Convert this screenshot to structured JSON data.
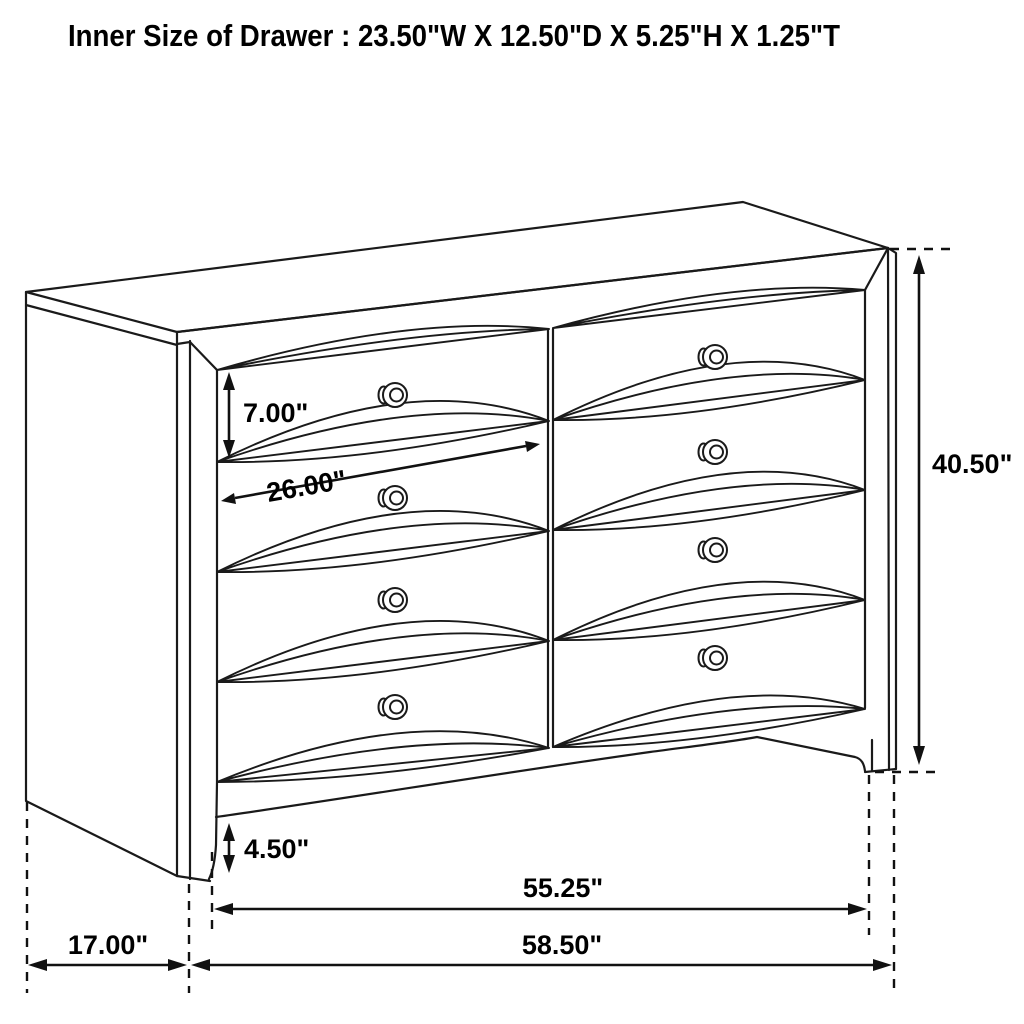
{
  "page": {
    "title": "Inner Size of Drawer : 23.50\"W X 12.50\"D X 5.25\"H X 1.25\"T",
    "background_color": "#ffffff",
    "line_color": "#1a1a1a"
  },
  "diagram": {
    "subject": "eight-drawer dresser line drawing",
    "view": "front three-quarter perspective",
    "drawer_grid": {
      "columns": 2,
      "rows": 4,
      "knobs": 8
    },
    "dimensions": [
      {
        "name": "top-drawer-front-height",
        "label": "7.00\"",
        "orientation": "vertical"
      },
      {
        "name": "drawer-front-width",
        "label": "26.00\"",
        "orientation": "diagonal"
      },
      {
        "name": "overall-height",
        "label": "40.50\"",
        "orientation": "vertical"
      },
      {
        "name": "base-to-floor-height",
        "label": "4.50\"",
        "orientation": "vertical"
      },
      {
        "name": "width-between-outer-legs",
        "label": "55.25\"",
        "orientation": "horizontal"
      },
      {
        "name": "side-depth",
        "label": "17.00\"",
        "orientation": "horizontal"
      },
      {
        "name": "overall-width",
        "label": "58.50\"",
        "orientation": "horizontal"
      }
    ]
  }
}
